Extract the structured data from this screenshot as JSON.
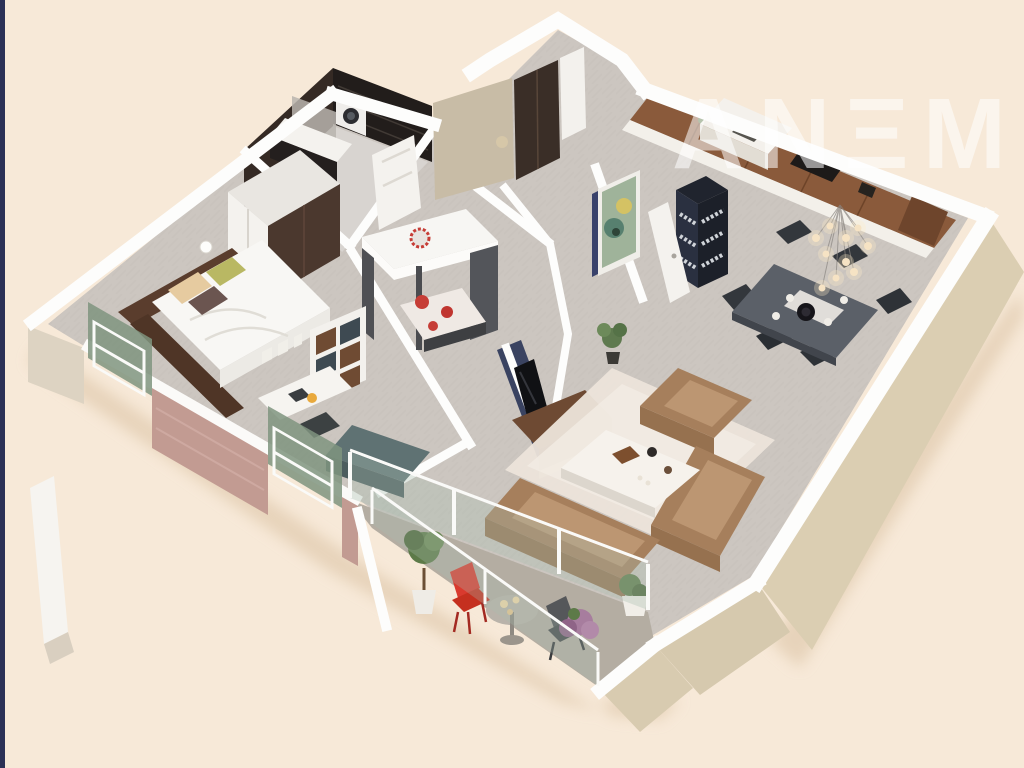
{
  "watermark": {
    "text": "ANΞM",
    "color": "rgba(255,255,255,0.55)"
  },
  "canvas": {
    "width": 1024,
    "height": 768
  },
  "colors": {
    "background": "#f7e9d8",
    "edge_strip": "#2b3156",
    "wall_white": "#fdfdfc",
    "wall_face_beige": "#dbceb2",
    "entry_face_taupe": "#c8bca6",
    "brick_pink": "#c29b92",
    "floor_gray": "#ccc6c0",
    "floor_bathroom": "#d8d4d0",
    "floor_terrace": "#b4ada2",
    "accent_navy": "#3a4361",
    "kitchen_wood": "#8a5a3b",
    "wardrobe_dark": "#3a2e27",
    "sofa_tan": "#a67f5c",
    "rug_cream": "#ece4da",
    "bed_white": "#f8f7f4",
    "kids_red": "#c63d36",
    "dining_table": "#5b6068",
    "chair_dark": "#33373c",
    "terrace_chair_red": "#d93a2e",
    "plant_green": "#5d7a48",
    "plant_purple": "#a77d9e",
    "glass_green": "#7f947f",
    "pendant_glow": "#f6e3c4"
  },
  "scene": {
    "type": "3d-floor-plan",
    "view": "isometric-render",
    "rooms": [
      {
        "name": "bathroom",
        "furniture": [
          "dark-mosaic-walls",
          "sink-vanity",
          "mirror",
          "washer",
          "toilet",
          "wood-cabinet"
        ]
      },
      {
        "name": "entry-hall",
        "furniture": [
          "wardrobe",
          "white-door",
          "artwork",
          "bookshelf"
        ]
      },
      {
        "name": "kitchen",
        "furniture": [
          "wood-cabinets",
          "island-counter",
          "cooktop"
        ]
      },
      {
        "name": "dining-area",
        "furniture": [
          "dark-table",
          "chairs",
          "pendant-light-cluster"
        ]
      },
      {
        "name": "living-room",
        "furniture": [
          "navy-tv-wall",
          "tv",
          "media-console",
          "rug",
          "coffee-table",
          "armchair",
          "sectional-sofa",
          "floor-plant"
        ]
      },
      {
        "name": "master-bedroom",
        "furniture": [
          "double-bed",
          "headboard",
          "pillows",
          "wardrobe",
          "cube-shelf",
          "desk",
          "chair",
          "lamp"
        ]
      },
      {
        "name": "kids-room",
        "furniture": [
          "loft-bed",
          "red-pattern-bedding",
          "dresser"
        ]
      },
      {
        "name": "terrace",
        "furniture": [
          "red-chair",
          "round-table",
          "candles",
          "gray-chair",
          "topiary",
          "purple-shrub",
          "green-planter",
          "glass-balustrade"
        ]
      },
      {
        "name": "bedroom-balcony",
        "furniture": [
          "green-glass-windows",
          "white-railings",
          "brick-wall"
        ]
      }
    ]
  }
}
